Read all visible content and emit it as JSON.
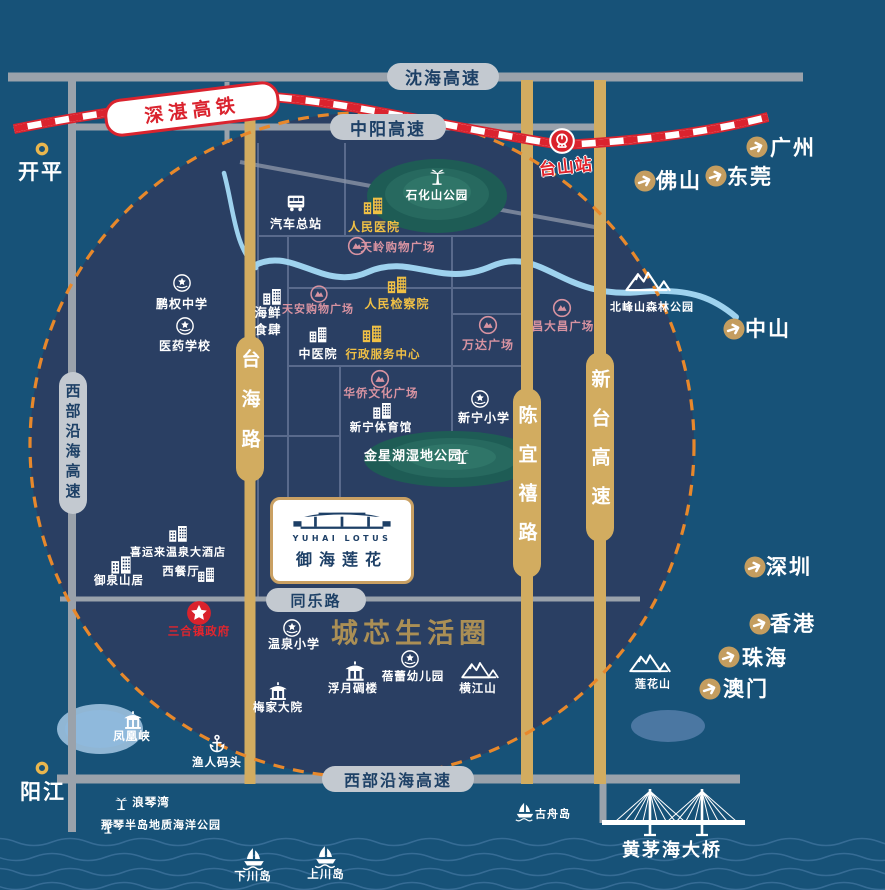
{
  "colors": {
    "white": "#ffffff",
    "yellow": "#f0c045",
    "pink": "#d893a1",
    "red": "#e1252e",
    "navy": "#1d4066",
    "slogan_gold": "#ab8f55",
    "road_gold": "#d2ac60",
    "road_gray": "#9aa2ab",
    "rail_red": "#da232e",
    "dash_orange": "#e8882b"
  },
  "roads": {
    "shenhai": "沈海高速",
    "zhongyang": "中阳高速",
    "xibu_left": "西部沿海高速",
    "xibu_bottom": "西部沿海高速",
    "tongle": "同乐路",
    "taihai": "台海路",
    "chenyixi": "陈宜禧路",
    "xintai": "新台高速"
  },
  "rail": {
    "label": "深湛高铁"
  },
  "bridge": {
    "label": "黄茅海大桥"
  },
  "project": {
    "en": "YUHAI LOTUS",
    "cn": "御海莲花"
  },
  "slogan": "城芯生活圈",
  "pois": [
    {
      "n": "汽车总站",
      "i": "bus",
      "s": 22,
      "x": 296,
      "y": 203,
      "lx": 296,
      "ly": 224,
      "c": "white"
    },
    {
      "n": "人民医院",
      "i": "buildings",
      "s": 22,
      "x": 373,
      "y": 205,
      "lx": 374,
      "ly": 227,
      "c": "yellow"
    },
    {
      "n": "石化山公园",
      "i": "palm",
      "s": 22,
      "x": 437,
      "y": 175,
      "lx": 437,
      "ly": 196,
      "c": "white",
      "fs": 11.5
    },
    {
      "n": "天岭购物广场",
      "i": "mall",
      "s": 20,
      "x": 357,
      "y": 246,
      "lx": 398,
      "ly": 248,
      "c": "pink",
      "fs": 11.5
    },
    {
      "n": "鹏权中学",
      "i": "badge",
      "s": 21,
      "x": 182,
      "y": 283,
      "lx": 182,
      "ly": 304,
      "c": "white"
    },
    {
      "n": "医药学校",
      "i": "badge",
      "s": 21,
      "x": 185,
      "y": 326,
      "lx": 185,
      "ly": 346,
      "c": "white"
    },
    {
      "n": "海鲜\n食肆",
      "i": "buildings",
      "s": 21,
      "x": 272,
      "y": 296,
      "lx": 268,
      "ly": 322,
      "c": "white",
      "fs": 12.5
    },
    {
      "n": "天安购物广场",
      "i": "mall",
      "s": 19,
      "x": 319,
      "y": 294,
      "lx": 318,
      "ly": 310,
      "c": "pink",
      "fs": 11
    },
    {
      "n": "人民检察院",
      "i": "buildings",
      "s": 22,
      "x": 397,
      "y": 284,
      "lx": 397,
      "ly": 304,
      "c": "yellow"
    },
    {
      "n": "中医院",
      "i": "buildings",
      "s": 20,
      "x": 318,
      "y": 334,
      "lx": 318,
      "ly": 354,
      "c": "white"
    },
    {
      "n": "行政服务中心",
      "i": "buildings",
      "s": 22,
      "x": 372,
      "y": 333,
      "lx": 383,
      "ly": 355,
      "c": "yellow",
      "fs": 11.5
    },
    {
      "n": "万达广场",
      "i": "mall",
      "s": 20,
      "x": 488,
      "y": 325,
      "lx": 488,
      "ly": 345,
      "c": "pink"
    },
    {
      "n": "昌大昌广场",
      "i": "mall",
      "s": 20,
      "x": 562,
      "y": 308,
      "lx": 563,
      "ly": 327,
      "c": "pink",
      "fs": 11.5
    },
    {
      "n": "北峰山森林公园",
      "i": "mountain",
      "s": 46,
      "h": 26,
      "x": 648,
      "y": 280,
      "lx": 652,
      "ly": 308,
      "c": "white",
      "fs": 11
    },
    {
      "n": "华侨文化广场",
      "i": "mall",
      "s": 20,
      "x": 380,
      "y": 379,
      "lx": 381,
      "ly": 394,
      "c": "pink",
      "fs": 11.5
    },
    {
      "n": "新宁体育馆",
      "i": "buildings",
      "s": 21,
      "x": 382,
      "y": 410,
      "lx": 381,
      "ly": 428,
      "c": "white",
      "fs": 11.5
    },
    {
      "n": "新宁小学",
      "i": "badge",
      "s": 21,
      "x": 480,
      "y": 399,
      "lx": 484,
      "ly": 418,
      "c": "white"
    },
    {
      "n": "金星湖湿地公园",
      "i": "palm",
      "s": 20,
      "x": 462,
      "y": 455,
      "lx": 413,
      "ly": 457,
      "c": "white",
      "fs": 13
    },
    {
      "n": "喜运来温泉大酒店",
      "i": "buildings",
      "s": 21,
      "x": 178,
      "y": 533,
      "lx": 178,
      "ly": 553,
      "c": "white",
      "fs": 11
    },
    {
      "n": "西餐厅",
      "i": "buildings",
      "s": 19,
      "x": 206,
      "y": 574,
      "lx": 181,
      "ly": 572,
      "c": "white",
      "fs": 11.5
    },
    {
      "n": "御泉山居",
      "i": "buildings",
      "s": 23,
      "x": 121,
      "y": 564,
      "lx": 119,
      "ly": 581,
      "c": "white",
      "fs": 11.5
    },
    {
      "n": "三合镇政府",
      "i": "star",
      "s": 26,
      "x": 199,
      "y": 613,
      "lx": 199,
      "ly": 632,
      "c": "red",
      "fs": 11.5
    },
    {
      "n": "温泉小学",
      "i": "badge",
      "s": 21,
      "x": 292,
      "y": 628,
      "lx": 294,
      "ly": 644,
      "c": "white"
    },
    {
      "n": "蓓蕾幼儿园",
      "i": "badge",
      "s": 21,
      "x": 410,
      "y": 659,
      "lx": 413,
      "ly": 677,
      "c": "white",
      "fs": 11.5
    },
    {
      "n": "浮月碉楼",
      "i": "pagoda",
      "s": 23,
      "x": 355,
      "y": 671,
      "lx": 353,
      "ly": 689,
      "c": "white",
      "fs": 11.5
    },
    {
      "n": "梅家大院",
      "i": "pagoda",
      "s": 21,
      "x": 278,
      "y": 691,
      "lx": 278,
      "ly": 708,
      "c": "white",
      "fs": 11.5
    },
    {
      "n": "横江山",
      "i": "mountain",
      "s": 38,
      "h": 22,
      "x": 480,
      "y": 669,
      "lx": 478,
      "ly": 689,
      "c": "white",
      "fs": 11.5
    },
    {
      "n": "莲花山",
      "i": "mountain",
      "s": 42,
      "h": 24,
      "x": 650,
      "y": 662,
      "lx": 653,
      "ly": 685,
      "c": "white",
      "fs": 11
    },
    {
      "n": "凤凰峡",
      "i": "pagoda",
      "s": 21,
      "x": 133,
      "y": 720,
      "lx": 132,
      "ly": 737,
      "c": "white",
      "fs": 11.5
    },
    {
      "n": "渔人码头",
      "i": "anchor",
      "s": 21,
      "x": 217,
      "y": 744,
      "lx": 217,
      "ly": 763,
      "c": "white",
      "fs": 11.5
    },
    {
      "n": "浪琴湾",
      "i": "palm",
      "s": 18,
      "x": 121,
      "y": 802,
      "lx": 151,
      "ly": 803,
      "c": "white",
      "fs": 11.5
    },
    {
      "n": "那琴半岛地质海洋公园",
      "i": "palm",
      "s": 17,
      "x": 108,
      "y": 826,
      "lx": 161,
      "ly": 826,
      "c": "white",
      "fs": 11
    },
    {
      "n": "古舟岛",
      "i": "boat",
      "s": 22,
      "x": 525,
      "y": 812,
      "lx": 553,
      "ly": 815,
      "c": "white",
      "fs": 11
    },
    {
      "n": "下川岛",
      "i": "boat",
      "s": 26,
      "x": 254,
      "y": 859,
      "lx": 253,
      "ly": 877,
      "c": "white",
      "fs": 11.5
    },
    {
      "n": "上川岛",
      "i": "boat",
      "s": 26,
      "x": 326,
      "y": 857,
      "lx": 326,
      "ly": 875,
      "c": "white",
      "fs": 11.5
    },
    {
      "n": "台山站",
      "i": "rail",
      "s": 27,
      "x": 562,
      "y": 141,
      "lx": 566,
      "ly": 168,
      "c": "red",
      "fs": 17,
      "rot": -6,
      "halo": true
    }
  ],
  "cities": [
    {
      "n": "开平",
      "i": "ring",
      "s": 16,
      "x": 42,
      "y": 149,
      "lx": 41,
      "ly": 172,
      "c": "white"
    },
    {
      "n": "阳江",
      "i": "ring",
      "s": 16,
      "x": 42,
      "y": 768,
      "lx": 43,
      "ly": 792,
      "c": "white"
    },
    {
      "n": "广州",
      "i": "arrow",
      "s": 23,
      "x": 757,
      "y": 147,
      "lx": 793,
      "ly": 148,
      "c": "white"
    },
    {
      "n": "佛山",
      "i": "arrow",
      "s": 23,
      "x": 645,
      "y": 181,
      "lx": 679,
      "ly": 181,
      "c": "white"
    },
    {
      "n": "东莞",
      "i": "arrow",
      "s": 23,
      "x": 716,
      "y": 176,
      "lx": 750,
      "ly": 177,
      "c": "white"
    },
    {
      "n": "中山",
      "i": "arrow",
      "s": 23,
      "x": 734,
      "y": 329,
      "lx": 768,
      "ly": 329,
      "c": "white"
    },
    {
      "n": "深圳",
      "i": "arrow",
      "s": 23,
      "x": 755,
      "y": 567,
      "lx": 789,
      "ly": 567,
      "c": "white"
    },
    {
      "n": "香港",
      "i": "arrow",
      "s": 23,
      "x": 760,
      "y": 624,
      "lx": 793,
      "ly": 624,
      "c": "white"
    },
    {
      "n": "珠海",
      "i": "arrow",
      "s": 23,
      "x": 729,
      "y": 657,
      "lx": 765,
      "ly": 658,
      "c": "white"
    },
    {
      "n": "澳门",
      "i": "arrow",
      "s": 23,
      "x": 710,
      "y": 689,
      "lx": 746,
      "ly": 689,
      "c": "white"
    }
  ]
}
